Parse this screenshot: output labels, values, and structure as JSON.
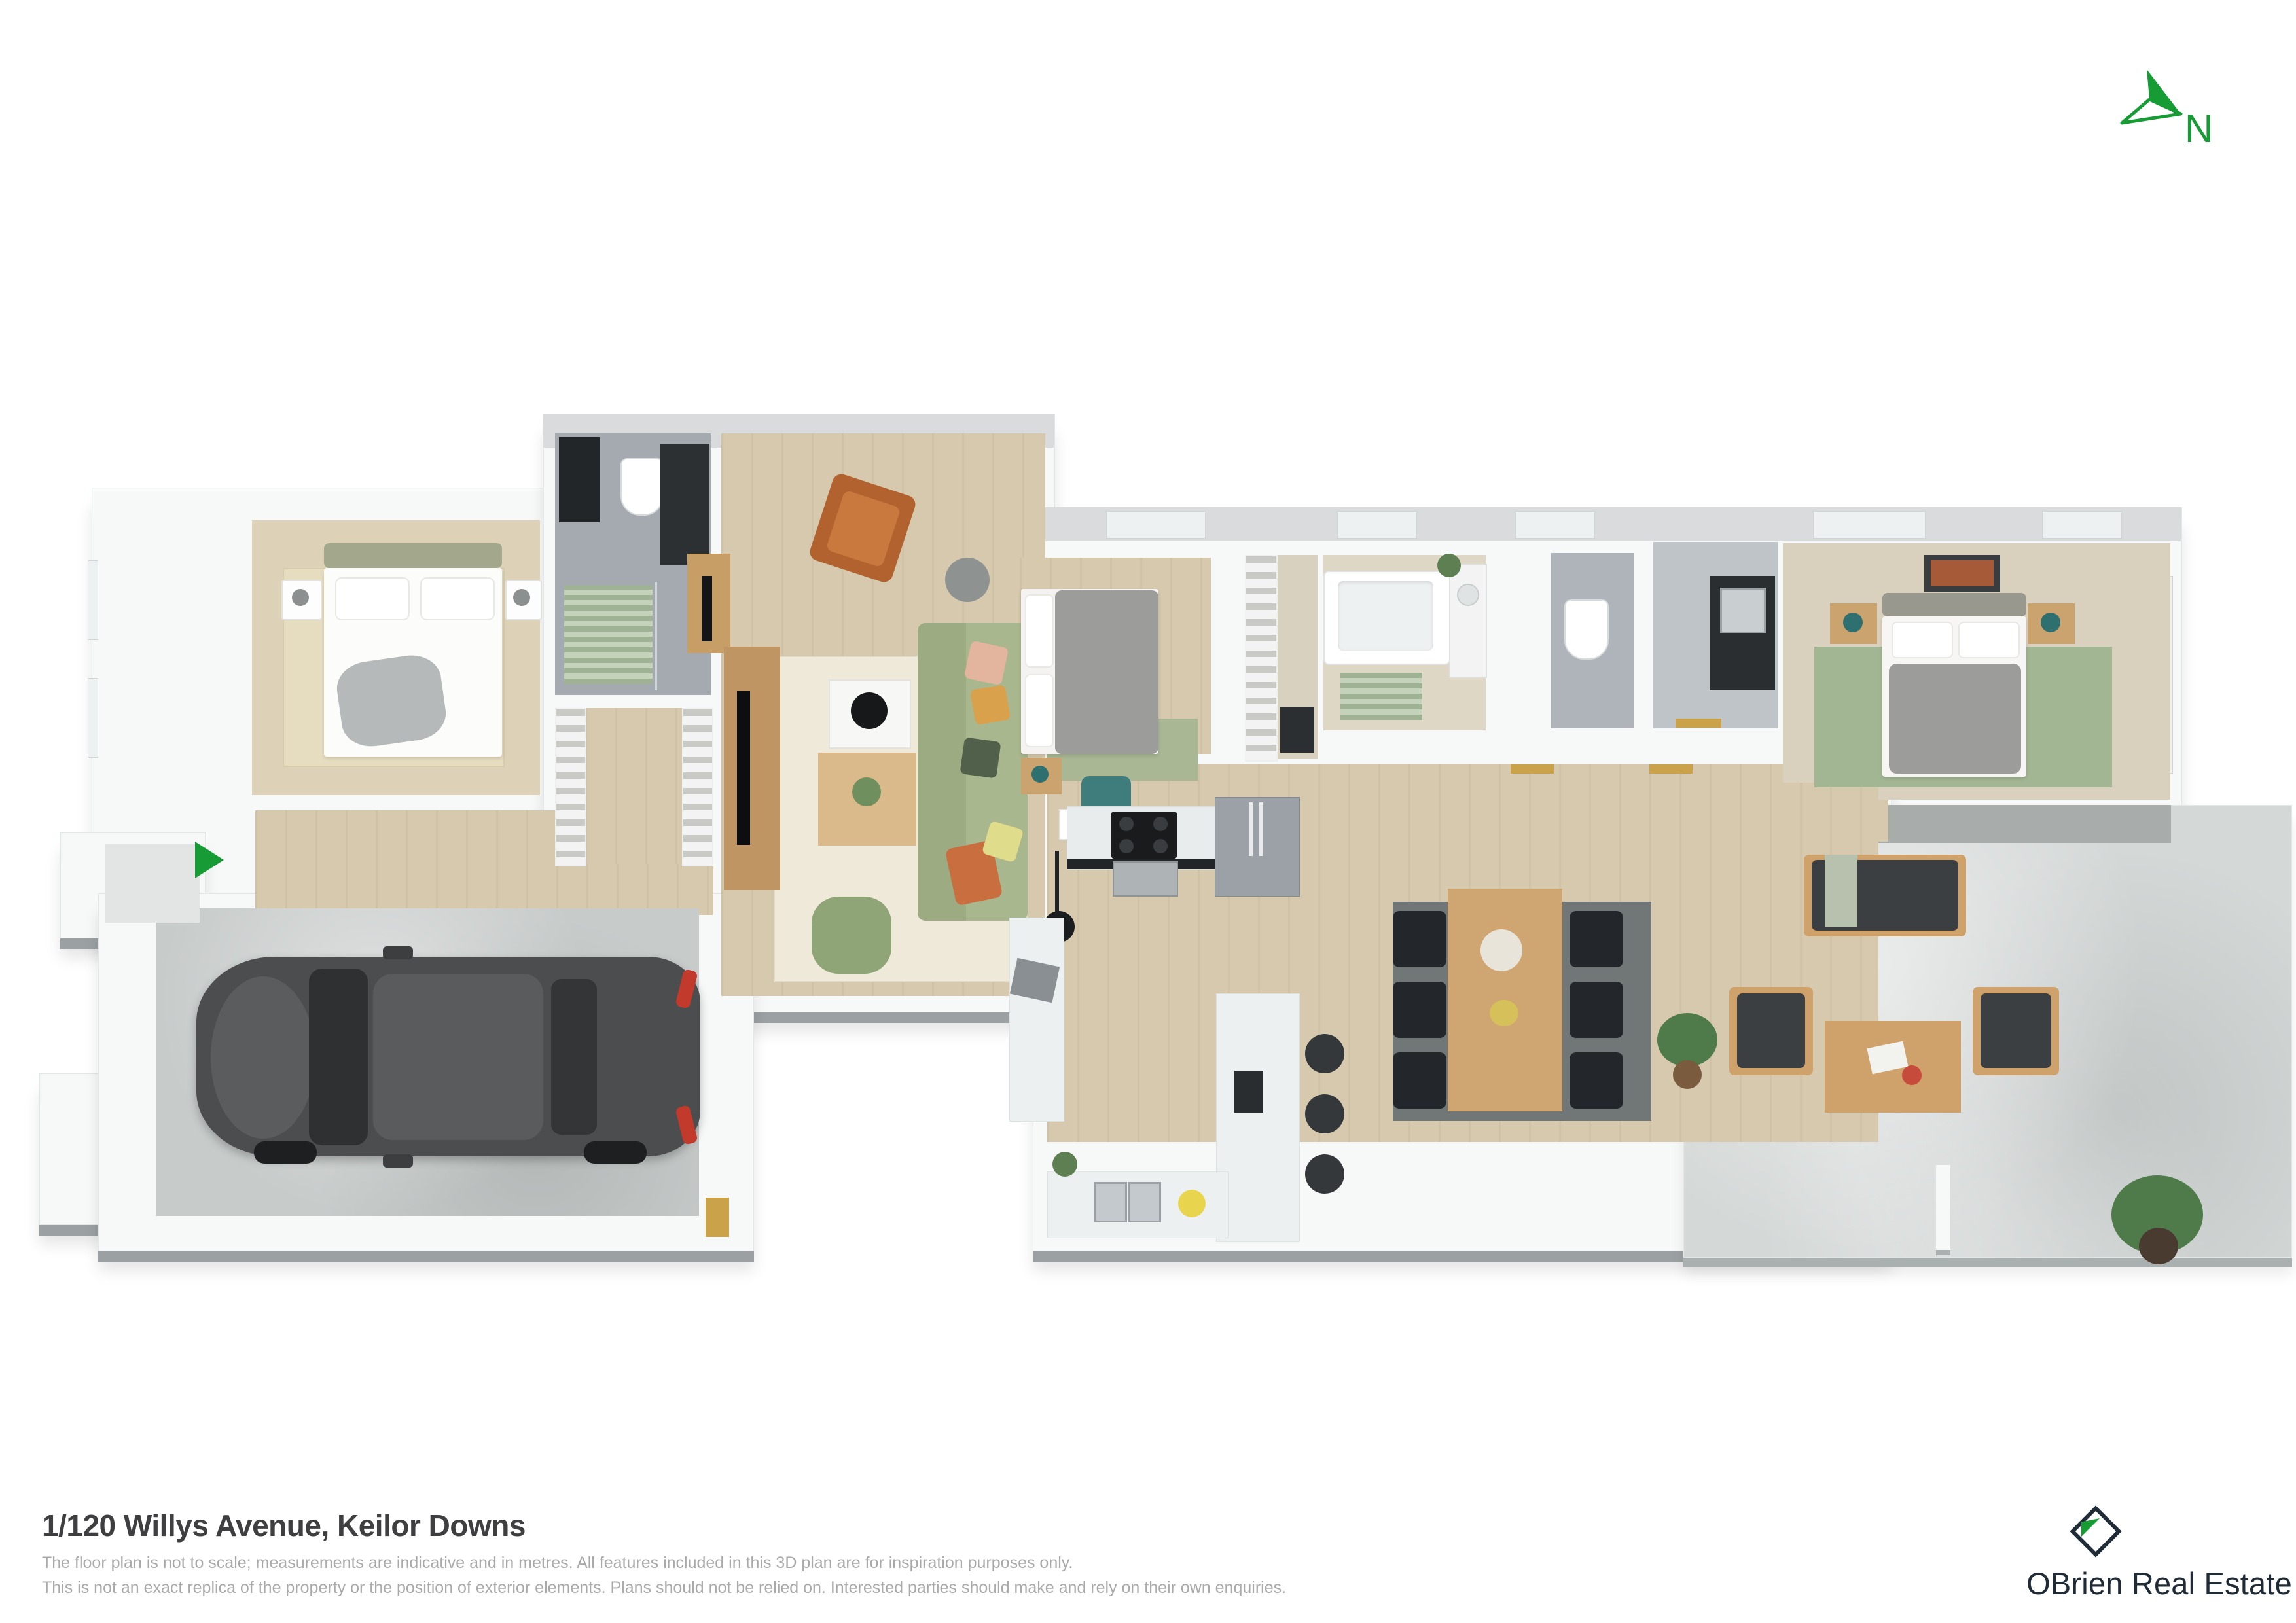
{
  "compass": {
    "label": "N"
  },
  "footer": {
    "title": "1/120 Willys Avenue, Keilor Downs",
    "disclaimer_line1": "The floor plan is not to scale; measurements are indicative and in metres. All features included in this 3D plan are for inspiration purposes only.",
    "disclaimer_line2": "This is not an exact replica of the property or the position of exterior elements. Plans should not be relied on. Interested parties should make and rely on their own enquiries."
  },
  "brand": {
    "name": "OBrien Real Estate"
  },
  "palette": {
    "accent_green": "#169b35",
    "brand_navy": "#1f2c38",
    "timber_floor": "#d6c9ae",
    "carpet_floor": "#ddd2b8",
    "tile_gray": "#a4aab0",
    "concrete_patio": "#d4d8d7",
    "garage_concrete": "#c7cbca",
    "wall_white": "#f7f8f8",
    "wall_shadow": "#9ba1a3",
    "sofa_green": "#a9b78f",
    "rug_green": "#a3b694",
    "leather_tan": "#b2622e",
    "outdoor_timber": "#cfa16b",
    "outdoor_cushion": "#3b3f42",
    "gold_door": "#c9a24a",
    "teal_accent": "#2e6f6f"
  }
}
